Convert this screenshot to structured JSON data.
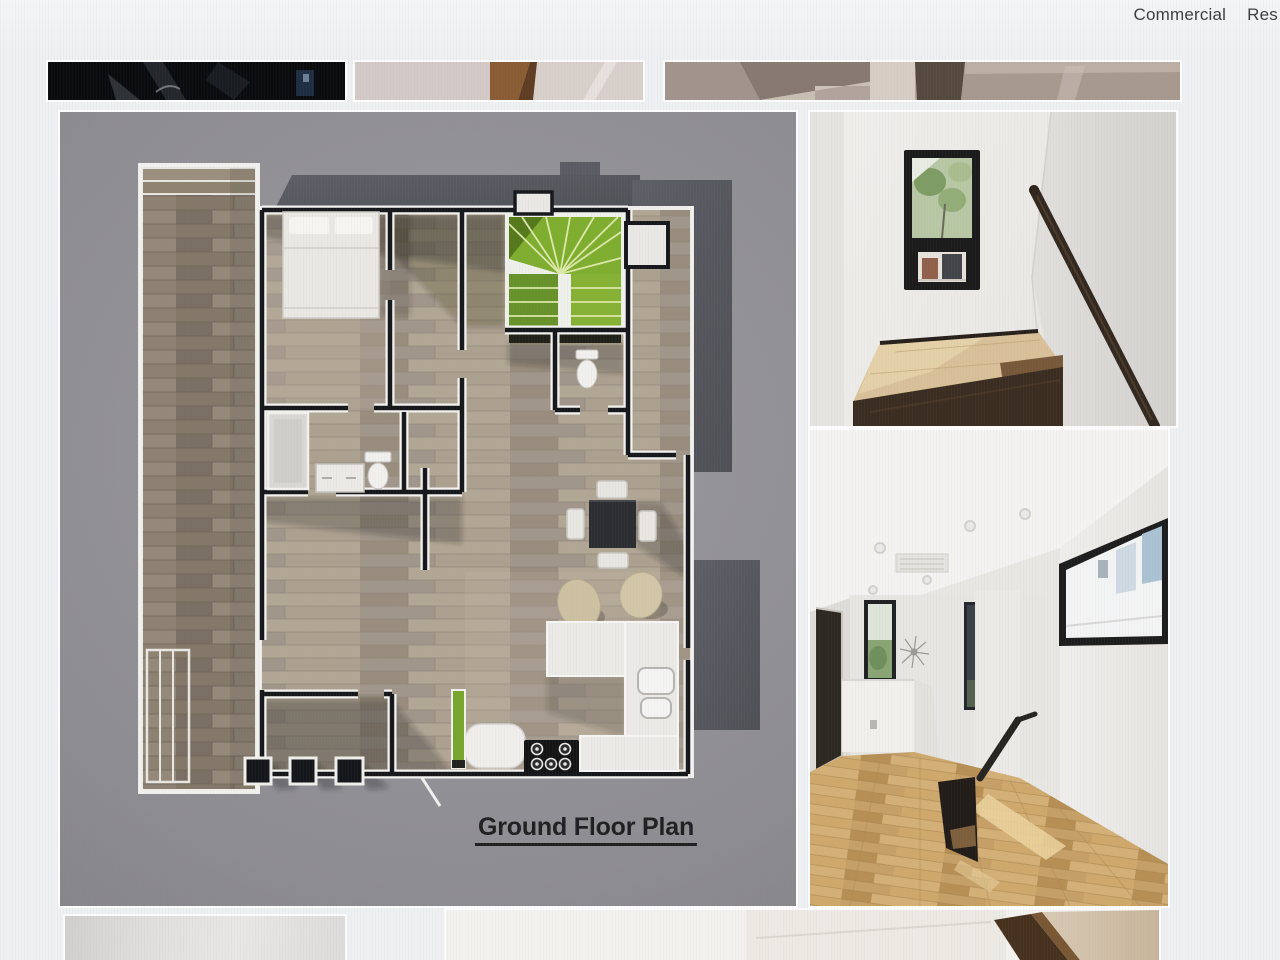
{
  "header": {
    "nav": [
      {
        "id": "commercial",
        "label": "Commercial"
      },
      {
        "id": "residential",
        "label": "Res"
      }
    ]
  },
  "gallery": {
    "floorplan_title": "Ground Floor Plan"
  },
  "colors": {
    "page_bg": "#eef0f1",
    "panel_gray": "#8e8d92",
    "stair_green": "#7fae2e",
    "stair_green_dark": "#55781b",
    "cabinet_green": "#76a62c",
    "oak_floor": "#c6a066",
    "handrail_brown": "#33281e",
    "wall_dark": "#16171a",
    "exterior_gray": "#585960",
    "nav_text": "#3e3e40",
    "title_text": "#1f1f1f"
  }
}
